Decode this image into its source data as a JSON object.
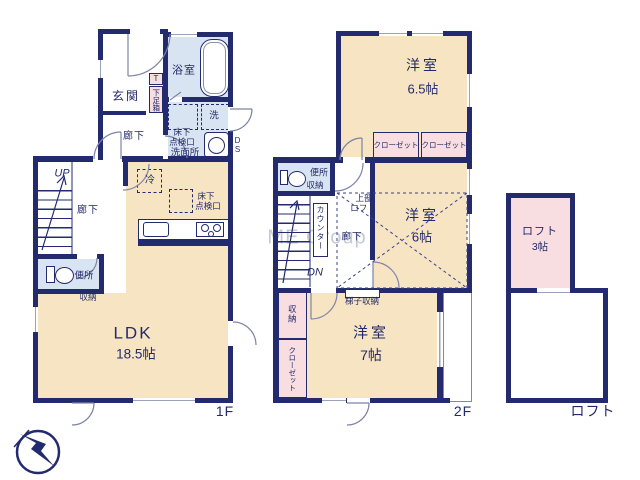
{
  "watermark": "ME Group",
  "colors": {
    "wall": "#232b6e",
    "room_cream": "#f7e4c3",
    "closet_pink": "#f8dde1",
    "wet_blue": "#d9e4f2",
    "label_navy": "#232a6b"
  },
  "floor1": {
    "floor_label": "1F",
    "genkan": "玄関",
    "shoe_t": "T",
    "shoe_box": "下足箱",
    "bath": "浴室",
    "hall_upper": "廊下",
    "laundry": "洗",
    "hatch_wash_l1": "床下",
    "hatch_wash_l2": "点検口",
    "washroom": "洗面所",
    "duct": "DS",
    "up": "UP",
    "hall_lower": "廊下",
    "fridge": "冷",
    "hatch_kitchen_l1": "床下",
    "hatch_kitchen_l2": "点検口",
    "toilet": "便所",
    "storage": "収納",
    "ldk": "LDK",
    "ldk_size": "18.5帖"
  },
  "floor2": {
    "floor_label": "2F",
    "bedroom1": "洋室",
    "bedroom1_size": "6.5帖",
    "closet1": "クローゼット",
    "closet2": "クローゼット",
    "toilet": "便所",
    "toilet_storage": "収納",
    "upper_loft_l1": "上部",
    "upper_loft_l2": "ロフト",
    "counter": "カウンター",
    "hall": "廊下",
    "dn": "DN",
    "bedroom2": "洋室",
    "bedroom2_size": "6帖",
    "ladder_storage": "梯子収納",
    "storage": "収納",
    "closet3": "クローゼット",
    "bedroom3": "洋室",
    "bedroom3_size": "7帖"
  },
  "loft": {
    "floor_label": "ロフト",
    "room": "ロフト",
    "room_size": "3帖"
  }
}
